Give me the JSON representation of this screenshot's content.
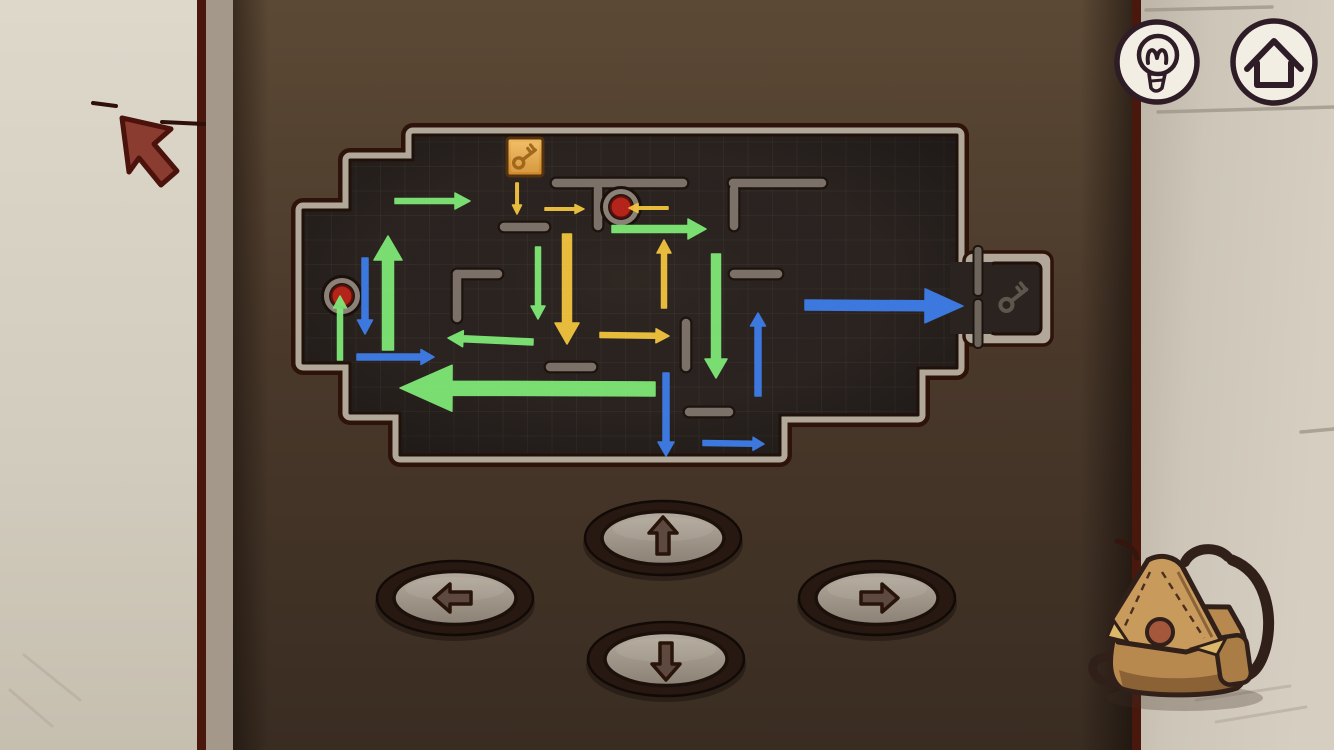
{
  "scene": {
    "width": 1334,
    "height": 750
  },
  "palette": {
    "panel_top": "#5c4935",
    "panel_mid": "#4a392b",
    "panel_bottom": "#392c21",
    "wall_left": "#d9d3c6",
    "wall_right": "#cdc6b8",
    "seam": "#4a170d",
    "shadow_strip": "#a3988a",
    "maze_bg": "#2a2320",
    "maze_border": "#b2a89a",
    "maze_border_dark": "#2e130b",
    "maze_inner_line": "#20120b",
    "wall_piece": "#7b7169",
    "wall_piece_outline": "#1d140f",
    "grid": "#6b5c4d",
    "arrow_green": "#7fe876",
    "arrow_yellow": "#f2c43e",
    "arrow_blue": "#3e7de9",
    "red_button": "#b3251a",
    "red_button_edge": "#5e0f08",
    "button_ring": "#8b8177",
    "key_tile_light": "#f0ba60",
    "key_tile_dark": "#cd882a",
    "key_tile_border": "#55330f",
    "key_glyph": "#9a6118",
    "exit_key_glyph": "#6b6258",
    "hud_bg": "#f2eee3",
    "hud_fg": "#2e1c27",
    "dpad_ring": "#271912",
    "dpad_face_light": "#b4aa9d",
    "dpad_face_dark": "#8c8175",
    "dpad_glyph": "#5d4940",
    "dpad_glyph_outline": "#281409",
    "cursor": "#8a3c31",
    "cursor_outline": "#4c130c",
    "backpack_body": "#b8894e",
    "backpack_flap": "#c89a5b",
    "backpack_strap": "#31201a",
    "backpack_pocket": "#aa7c46",
    "backpack_button": "#a5573c",
    "backpack_corner": "#dcb96a"
  },
  "hud": {
    "buttons": [
      {
        "name": "hint-button",
        "icon": "lightbulb-icon",
        "cx": 1157,
        "cy": 62,
        "r": 40
      },
      {
        "name": "home-button",
        "icon": "home-icon",
        "cx": 1274,
        "cy": 62,
        "r": 41
      }
    ]
  },
  "maze": {
    "outline": [
      [
        413,
        135
      ],
      [
        957,
        135
      ],
      [
        957,
        368
      ],
      [
        918,
        368
      ],
      [
        918,
        415
      ],
      [
        780,
        415
      ],
      [
        780,
        455
      ],
      [
        400,
        455
      ],
      [
        400,
        413
      ],
      [
        350,
        413
      ],
      [
        350,
        363
      ],
      [
        303,
        363
      ],
      [
        303,
        210
      ],
      [
        350,
        210
      ],
      [
        350,
        160
      ],
      [
        413,
        160
      ]
    ],
    "grid_step": 24.5,
    "walls": [
      [
        556,
        183,
        683,
        183
      ],
      [
        598,
        189,
        598,
        226
      ],
      [
        733,
        183,
        822,
        183
      ],
      [
        734,
        189,
        734,
        226
      ],
      [
        504,
        227,
        545,
        227
      ],
      [
        457,
        274,
        498,
        274
      ],
      [
        457,
        274,
        457,
        318
      ],
      [
        734,
        274,
        778,
        274
      ],
      [
        550,
        367,
        592,
        367
      ],
      [
        686,
        323,
        686,
        367
      ],
      [
        689,
        412,
        729,
        412
      ]
    ],
    "red_buttons": [
      {
        "cx": 342,
        "cy": 296
      },
      {
        "cx": 621,
        "cy": 207
      }
    ],
    "key_tile": {
      "x": 507,
      "y": 138,
      "w": 36,
      "h": 38
    },
    "exit": {
      "frame": {
        "x": 964,
        "y": 252,
        "w": 88,
        "h": 93
      },
      "inner": {
        "x": 989,
        "y": 263,
        "w": 52,
        "h": 71
      },
      "passage": {
        "x": 950,
        "y": 262,
        "w": 42,
        "h": 72
      },
      "posts": [
        [
          973.5,
          246,
          9,
          50
        ],
        [
          973.5,
          299,
          9,
          49
        ]
      ],
      "glyph_cx": 1014,
      "glyph_cy": 299
    },
    "arrows": [
      {
        "color": "green",
        "x1": 395,
        "y1": 201,
        "x2": 470,
        "y2": 201,
        "shaft": 5,
        "headW": 16,
        "headL": 15
      },
      {
        "color": "yellow",
        "x1": 517,
        "y1": 183,
        "x2": 517,
        "y2": 214,
        "shaft": 2.5,
        "headW": 9,
        "headL": 9
      },
      {
        "color": "yellow",
        "x1": 545,
        "y1": 209,
        "x2": 584,
        "y2": 209,
        "shaft": 2.5,
        "headW": 9,
        "headL": 9
      },
      {
        "color": "yellow",
        "x1": 668,
        "y1": 208,
        "x2": 629,
        "y2": 208,
        "shaft": 2.5,
        "headW": 9,
        "headL": 9
      },
      {
        "color": "green",
        "x1": 612,
        "y1": 229,
        "x2": 706,
        "y2": 229,
        "shaft": 7,
        "headW": 20,
        "headL": 18
      },
      {
        "color": "yellow",
        "x1": 664,
        "y1": 308,
        "x2": 664,
        "y2": 240,
        "shaft": 5,
        "headW": 14,
        "headL": 13
      },
      {
        "color": "green",
        "x1": 388,
        "y1": 350,
        "x2": 388,
        "y2": 236,
        "shaft": 11,
        "headW": 28,
        "headL": 24
      },
      {
        "color": "blue",
        "x1": 365,
        "y1": 258,
        "x2": 365,
        "y2": 334,
        "shaft": 6,
        "headW": 15,
        "headL": 14
      },
      {
        "color": "green",
        "x1": 340,
        "y1": 360,
        "x2": 340,
        "y2": 296,
        "shaft": 5,
        "headW": 13,
        "headL": 12
      },
      {
        "color": "green",
        "x1": 538,
        "y1": 247,
        "x2": 538,
        "y2": 319,
        "shaft": 5,
        "headW": 14,
        "headL": 13
      },
      {
        "color": "yellow",
        "x1": 567,
        "y1": 234,
        "x2": 567,
        "y2": 344,
        "shaft": 9,
        "headW": 24,
        "headL": 21
      },
      {
        "color": "green",
        "x1": 716,
        "y1": 254,
        "x2": 716,
        "y2": 378,
        "shaft": 9,
        "headW": 22,
        "headL": 19
      },
      {
        "color": "green",
        "x1": 533,
        "y1": 342,
        "x2": 448,
        "y2": 338,
        "shaft": 6,
        "headW": 16,
        "headL": 15
      },
      {
        "color": "yellow",
        "x1": 600,
        "y1": 335,
        "x2": 669,
        "y2": 336,
        "shaft": 5,
        "headW": 14,
        "headL": 13
      },
      {
        "color": "blue",
        "x1": 357,
        "y1": 357,
        "x2": 434,
        "y2": 357,
        "shaft": 6,
        "headW": 15,
        "headL": 13
      },
      {
        "color": "green",
        "x1": 655,
        "y1": 389,
        "x2": 400,
        "y2": 388,
        "shaft": 14,
        "headW": 46,
        "headL": 52
      },
      {
        "color": "blue",
        "x1": 805,
        "y1": 305,
        "x2": 963,
        "y2": 306,
        "shaft": 10,
        "headW": 34,
        "headL": 38
      },
      {
        "color": "blue",
        "x1": 758,
        "y1": 396,
        "x2": 758,
        "y2": 313,
        "shaft": 6,
        "headW": 15,
        "headL": 13
      },
      {
        "color": "blue",
        "x1": 666,
        "y1": 373,
        "x2": 666,
        "y2": 456,
        "shaft": 6,
        "headW": 16,
        "headL": 14
      },
      {
        "color": "blue",
        "x1": 703,
        "y1": 443,
        "x2": 764,
        "y2": 444,
        "shaft": 5,
        "headW": 13,
        "headL": 11
      }
    ]
  },
  "dpad": {
    "rx": 78,
    "ry": 37,
    "buttons": [
      {
        "name": "dpad-up-button",
        "dir": "up",
        "cx": 663,
        "cy": 538,
        "rot": 0
      },
      {
        "name": "dpad-left-button",
        "dir": "left",
        "cx": 455,
        "cy": 598,
        "rot": -90
      },
      {
        "name": "dpad-right-button",
        "dir": "right",
        "cx": 877,
        "cy": 598,
        "rot": 90
      },
      {
        "name": "dpad-down-button",
        "dir": "down",
        "cx": 666,
        "cy": 659,
        "rot": 180
      }
    ]
  },
  "decor": {
    "cursor_points": "122,118 171,129 154,144 177,171 161,185 139,158 129,172",
    "wall_marks": [
      [
        93,
        103,
        116,
        106
      ],
      [
        162,
        122,
        204,
        124
      ]
    ],
    "brick_lines": [
      [
        1146,
        10,
        1272,
        7
      ],
      [
        1158,
        112,
        1334,
        107
      ],
      [
        1301,
        432,
        1334,
        429
      ]
    ],
    "scratches": [
      [
        1196,
        700,
        1290,
        686
      ],
      [
        1216,
        722,
        1306,
        707
      ],
      [
        24,
        655,
        80,
        700
      ],
      [
        10,
        690,
        52,
        726
      ]
    ]
  }
}
